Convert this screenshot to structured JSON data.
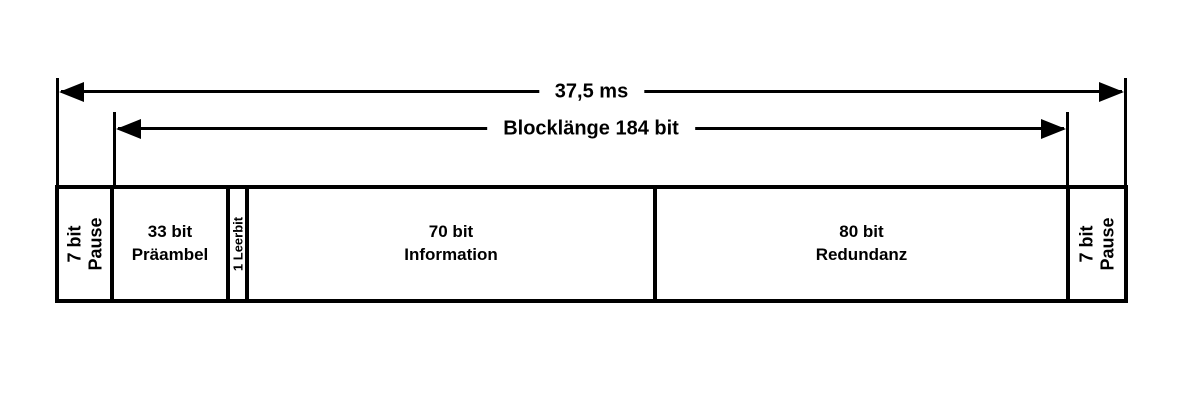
{
  "diagram": {
    "colors": {
      "foreground": "#000000",
      "background": "#ffffff"
    },
    "arrows": {
      "total": {
        "label": "37,5 ms"
      },
      "block": {
        "label": "Blocklänge 184 bit"
      }
    },
    "segments": [
      {
        "name": "pause-left",
        "line1": "7 bit",
        "line2": "Pause"
      },
      {
        "name": "praeambel",
        "line1": "33 bit",
        "line2": "Präambel"
      },
      {
        "name": "leerbit",
        "line1": "1 Leerbit",
        "line2": ""
      },
      {
        "name": "information",
        "line1": "70 bit",
        "line2": "Information"
      },
      {
        "name": "redundanz",
        "line1": "80 bit",
        "line2": "Redundanz"
      },
      {
        "name": "pause-right",
        "line1": "7 bit",
        "line2": "Pause"
      }
    ]
  }
}
